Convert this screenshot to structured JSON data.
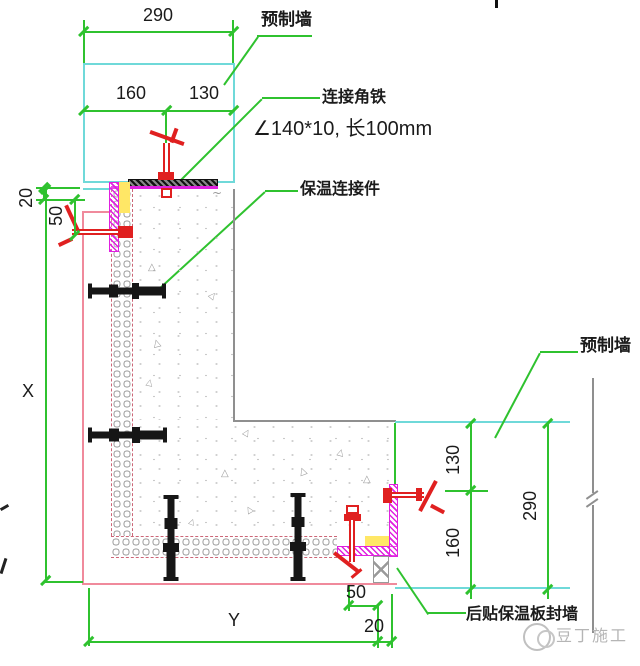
{
  "title": "预制墙连接节点详图",
  "top": {
    "dim_290": "290",
    "dim_160": "160",
    "dim_130": "130"
  },
  "labels": {
    "precast_top": "预制墙",
    "angle_iron": "连接角铁",
    "angle_spec": "∠140*10, 长100mm",
    "insulation_connector": "保温连接件",
    "precast_right": "预制墙",
    "seal_wall": "后贴保温板封墙"
  },
  "left": {
    "dim_20": "20",
    "dim_50": "50",
    "dim_x": "X"
  },
  "right": {
    "dim_130": "130",
    "dim_290": "290",
    "dim_160": "160"
  },
  "bottom": {
    "dim_y": "Y",
    "dim_50": "50",
    "dim_20": "20"
  },
  "watermark": {
    "text": "豆丁施工"
  },
  "glyphs": {
    "triangle": "△",
    "squiggle": "~"
  },
  "colors": {
    "dimension_green": "#2fc22f",
    "precast_cyan": "#6fd9d9",
    "finish_pink": "#f08a9c",
    "seal_magenta": "#e020e0",
    "clamp_red": "#e02020",
    "grout_yellow": "#ffe766"
  }
}
